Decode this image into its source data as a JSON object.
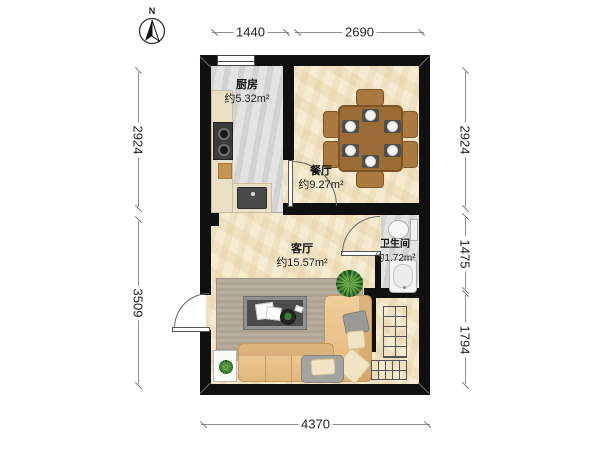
{
  "compass": {
    "label": "N"
  },
  "dimensions": {
    "top": [
      "1440",
      "2690"
    ],
    "left": [
      "2924",
      "3509"
    ],
    "right": [
      "2924",
      "1475",
      "1794"
    ],
    "bottom": [
      "4370"
    ]
  },
  "rooms": {
    "kitchen": {
      "name": "厨房",
      "area": "约5.32m²"
    },
    "dining": {
      "name": "餐厅",
      "area": "约9.27m²"
    },
    "living": {
      "name": "客厅",
      "area": "约15.57m²"
    },
    "bathroom": {
      "name": "卫生间",
      "area": "约1.72m²"
    }
  },
  "colors": {
    "wall": "#101010",
    "floor_warm": "#f2e8cb",
    "floor_cool": "#dcdcda",
    "wood": "#9b6c35",
    "sofa": "#eec690",
    "dim_text": "#222222"
  }
}
